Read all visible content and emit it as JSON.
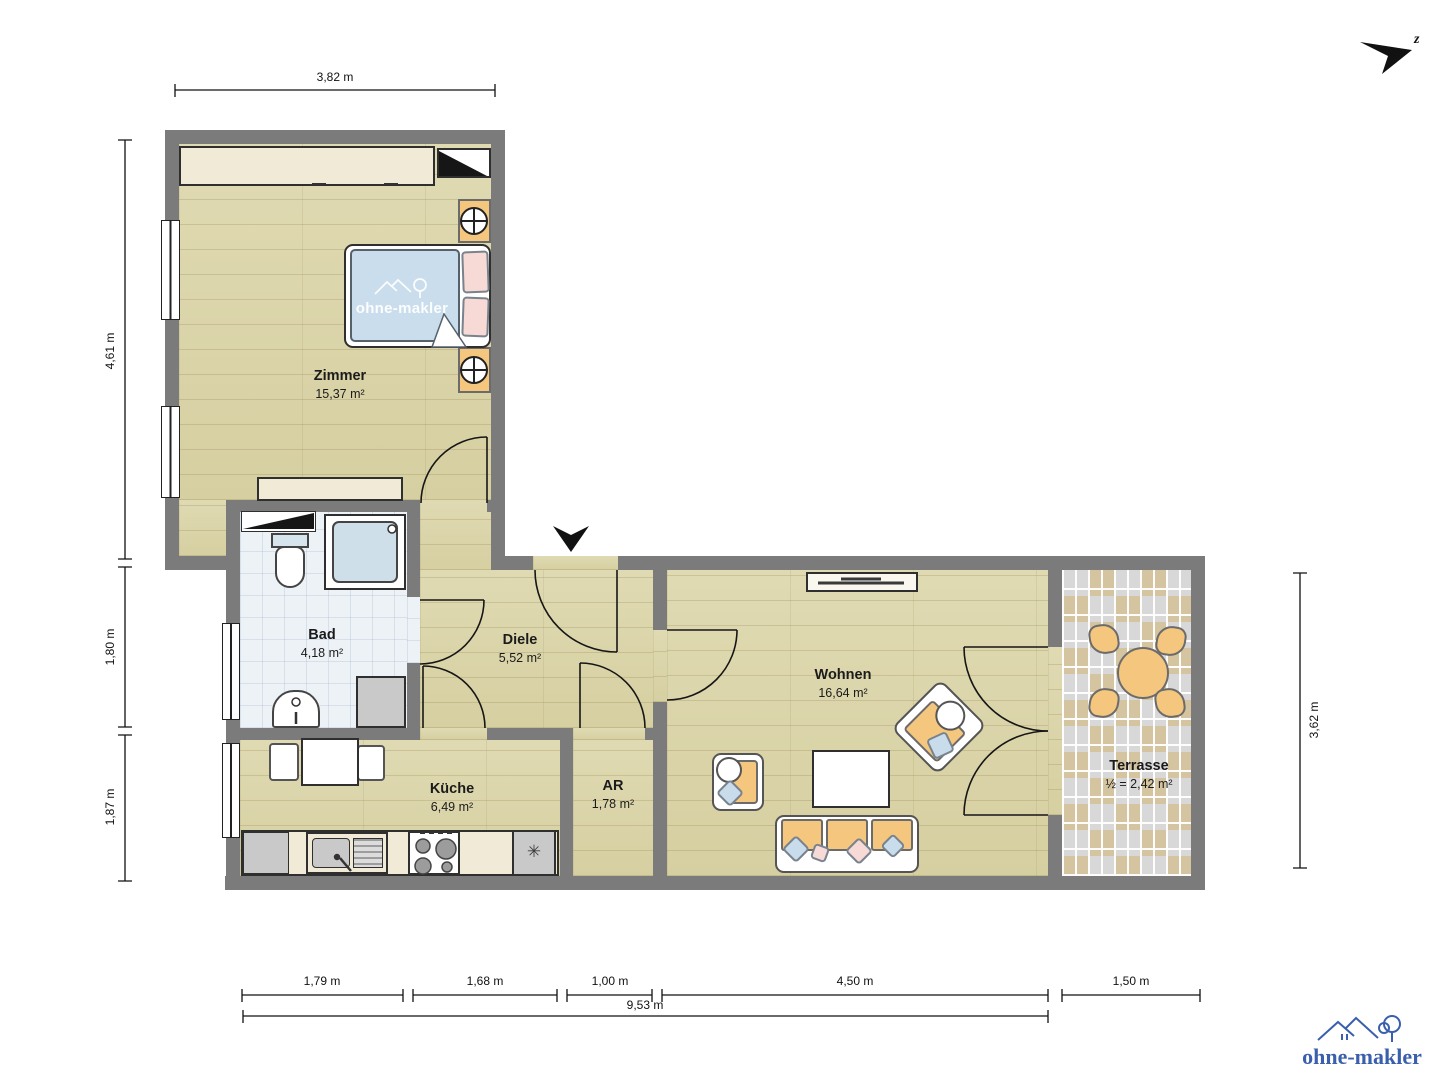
{
  "rooms": [
    {
      "id": "zimmer",
      "name": "Zimmer",
      "area": "15,37 m²"
    },
    {
      "id": "bad",
      "name": "Bad",
      "area": "4,18 m²"
    },
    {
      "id": "diele",
      "name": "Diele",
      "area": "5,52 m²"
    },
    {
      "id": "kueche",
      "name": "Küche",
      "area": "6,49 m²"
    },
    {
      "id": "ar",
      "name": "AR",
      "area": "1,78 m²"
    },
    {
      "id": "wohnen",
      "name": "Wohnen",
      "area": "16,64 m²"
    },
    {
      "id": "terrasse",
      "name": "Terrasse",
      "area": "½ = 2,42 m²"
    }
  ],
  "dimensions": {
    "top": "3,82 m",
    "left": [
      "4,61 m",
      "1,80 m",
      "1,87 m"
    ],
    "right": "3,62 m",
    "bottom": [
      "1,79 m",
      "1,68 m",
      "1,00 m",
      "4,50 m",
      "1,50 m"
    ],
    "total": "9,53 m"
  },
  "branding": {
    "watermark_text": "ohne-makler",
    "logo_text": "ohne-makler",
    "logo_color": "#3a5fad"
  },
  "north": {
    "label": "z"
  },
  "symbols": {
    "fridge": "✳"
  },
  "colors": {
    "wall": "#7b7b7b",
    "wood_floor": "#dbd4a8",
    "bath_floor": "#edf2f7",
    "terrace_tile_tan": "#d4c4a0",
    "terrace_tile_gray": "#d8d8d8",
    "furniture_cream": "#f1ead7",
    "furniture_orange": "#f5c67d",
    "textile_blue": "#c8dcec",
    "textile_pink": "#f7d9d6"
  }
}
